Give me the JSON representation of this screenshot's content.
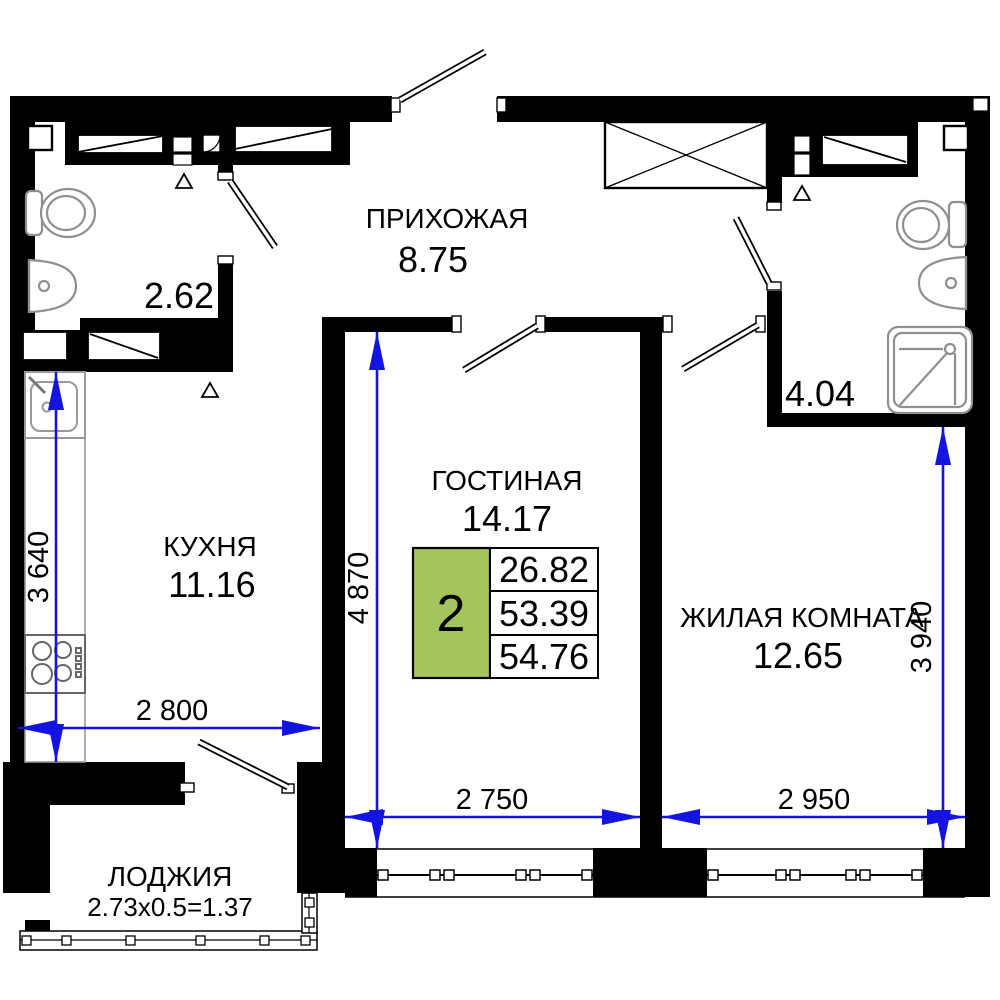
{
  "rooms": {
    "hallway": {
      "label": "ПРИХОЖАЯ",
      "area": "8.75"
    },
    "kitchen": {
      "label": "КУХНЯ",
      "area": "11.16"
    },
    "living_room": {
      "label": "ГОСТИНАЯ",
      "area": "14.17"
    },
    "bedroom": {
      "label": "ЖИЛАЯ КОМНАТА",
      "area": "12.65"
    },
    "loggia": {
      "label": "ЛОДЖИЯ",
      "area": "2.73x0.5=1.37"
    },
    "bathroom_small": {
      "area": "2.62"
    },
    "bathroom_large": {
      "area": "4.04"
    }
  },
  "apartment_summary": {
    "rooms_count": "2",
    "living_area": "26.82",
    "area_without_loggia": "53.39",
    "total_area": "54.76"
  },
  "dimensions": {
    "kitchen_width": "2 800",
    "kitchen_depth": "3 640",
    "living_width": "2 750",
    "living_depth": "4 870",
    "bedroom_width": "2 950",
    "bedroom_depth": "3 940"
  },
  "colors": {
    "wall": "#000000",
    "dimension_blue": "#1414e0",
    "accent_green": "#a6c45c",
    "fixture_gray": "#8f8f8f"
  }
}
